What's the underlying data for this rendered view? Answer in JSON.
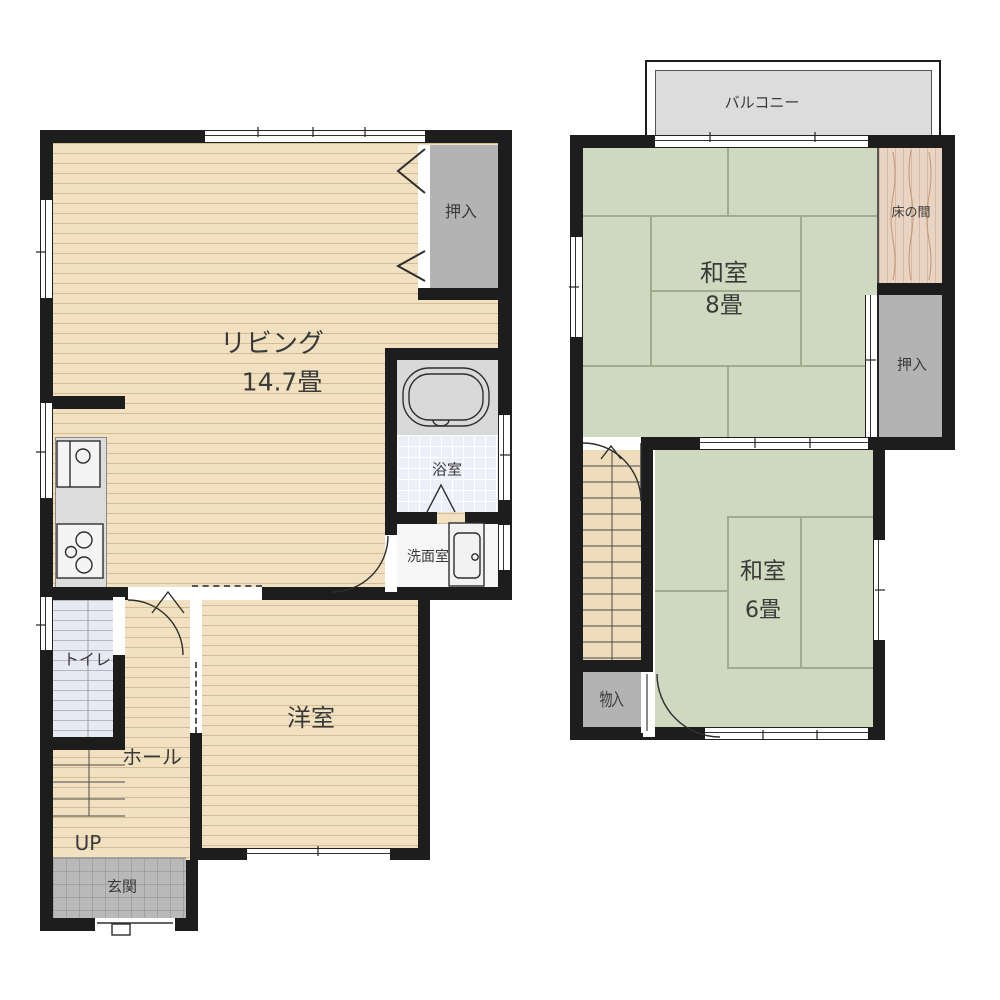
{
  "floor1": {
    "living": {
      "label": "リビング",
      "size": "14.7畳"
    },
    "closet": {
      "label": "押入"
    },
    "bath": {
      "label": "浴室"
    },
    "washroom": {
      "label": "洗面室"
    },
    "toilet": {
      "label": "トイレ"
    },
    "hall": {
      "label": "ホール"
    },
    "stairs_up": {
      "label": "UP"
    },
    "entrance": {
      "label": "玄関"
    },
    "western_room": {
      "label": "洋室"
    }
  },
  "floor2": {
    "balcony": {
      "label": "バルコニー"
    },
    "japanese_room_8": {
      "label": "和室",
      "size": "8畳"
    },
    "tokonoma": {
      "label": "床の間"
    },
    "closet": {
      "label": "押入"
    },
    "japanese_room_6": {
      "label": "和室",
      "size": "6畳"
    },
    "storage": {
      "label": "物入"
    }
  },
  "colors": {
    "wall": "#1d1d1d",
    "wood_floor": "#f2e1c0",
    "tatami": "#cfd9bf",
    "closet_gray": "#b3b3b3",
    "balcony": "#dcdcdc",
    "entrance_tile": "#b9b9b9",
    "stair_hall": "#e9e9f4",
    "bath_tile": "#edeff8",
    "tokonoma": "#e9d3c3",
    "label_text": "#3a3a3a"
  }
}
